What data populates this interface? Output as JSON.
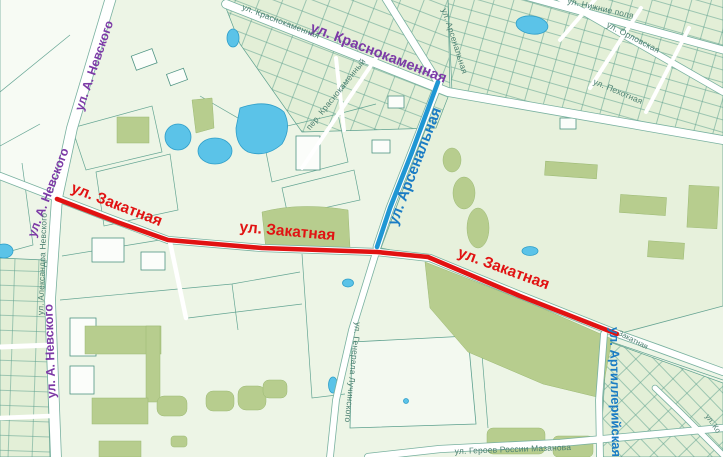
{
  "map": {
    "type": "city-street-map",
    "canvas": {
      "width": 723,
      "height": 457
    },
    "palette": {
      "background": "#edf5e6",
      "block_fill": "#e4f0d8",
      "park_fill": "#b7cd8e",
      "water_fill": "#5bc3e8",
      "road_fill": "#ffffff",
      "boundary_stroke": "#5da08e",
      "major_label_color": "#7c3aa6",
      "minor_label_color": "#4b7f70",
      "route_red": "#e11212",
      "route_blue": "#1f97d4"
    },
    "routes": [
      {
        "id": "zakatnaya",
        "street": "ул. Закатная",
        "color": "#e11212"
      },
      {
        "id": "arsenalnaya",
        "street": "ул. Арсенальная",
        "color": "#1f97d4"
      }
    ],
    "street_labels": [
      {
        "id": "nevskogo-upper",
        "text": "ул. А. Невского",
        "x": 98,
        "y": 67,
        "rot": -71,
        "cls": "major"
      },
      {
        "id": "nevskogo-middle",
        "text": "ул. А. Невского",
        "x": 52,
        "y": 194,
        "rot": -69,
        "cls": "major"
      },
      {
        "id": "nevskogo-lower",
        "text": "ул. А. Невского",
        "x": 54,
        "y": 351,
        "rot": -92,
        "cls": "major"
      },
      {
        "id": "krasnokamennaya-major",
        "text": "ул. Краснокаменная",
        "x": 377,
        "y": 57,
        "rot": 21,
        "cls": "major-lg"
      },
      {
        "id": "krasnokamennaya-minor",
        "text": "ул. Краснокаменная",
        "x": 280,
        "y": 24,
        "rot": 21,
        "cls": "minor"
      },
      {
        "id": "pereulok-krasnokamenny",
        "text": "пер. Краснокаменный",
        "x": 338,
        "y": 96,
        "rot": -51,
        "cls": "minor"
      },
      {
        "id": "arsenalnaya-minor",
        "text": "ул. Арсенальная",
        "x": 452,
        "y": 42,
        "rot": 72,
        "cls": "minor"
      },
      {
        "id": "nizhnie-polya",
        "text": "ул. Нижние поля",
        "x": 600,
        "y": 11,
        "rot": 13,
        "cls": "minor"
      },
      {
        "id": "orlovskaya",
        "text": "ул. Орловская",
        "x": 632,
        "y": 40,
        "rot": 27,
        "cls": "minor"
      },
      {
        "id": "pekhotnaya",
        "text": "ул. Пехотная",
        "x": 617,
        "y": 94,
        "rot": 23,
        "cls": "minor"
      },
      {
        "id": "aleksandra-nevskogo",
        "text": "ул. Александра Невского",
        "x": 45,
        "y": 264,
        "rot": -88,
        "cls": "minor"
      },
      {
        "id": "generala-luchinskogo",
        "text": "ул. Генерала Лучинского",
        "x": 350,
        "y": 372,
        "rot": 96,
        "cls": "minor"
      },
      {
        "id": "geroyev-rossii",
        "text": "ул. Героев России Мазанова",
        "x": 513,
        "y": 452,
        "rot": -2,
        "cls": "minor"
      },
      {
        "id": "zakatnaya-minor",
        "text": "Закатная",
        "x": 632,
        "y": 342,
        "rot": 27,
        "cls": "minor-sm"
      },
      {
        "id": "ko-street",
        "text": "ул. Ко",
        "x": 711,
        "y": 425,
        "rot": 55,
        "cls": "minor-sm"
      },
      {
        "id": "zakatnaya-route-west",
        "text": "ул. Закатная",
        "x": 115,
        "y": 209,
        "rot": 21,
        "cls": "route-red"
      },
      {
        "id": "zakatnaya-route-center",
        "text": "ул. Закатная",
        "x": 287,
        "y": 236,
        "rot": 5,
        "cls": "route-red"
      },
      {
        "id": "zakatnaya-route-east",
        "text": "ул. Закатная",
        "x": 502,
        "y": 273,
        "rot": 20,
        "cls": "route-red"
      },
      {
        "id": "arsenalnaya-route",
        "text": "ул. Арсенальная",
        "x": 419,
        "y": 168,
        "rot": -69,
        "cls": "route-blue"
      },
      {
        "id": "artilleriyskaya",
        "text": "ул. Артиллерийская",
        "x": 611,
        "y": 392,
        "rot": 89,
        "cls": "route-blue-sm"
      }
    ]
  }
}
